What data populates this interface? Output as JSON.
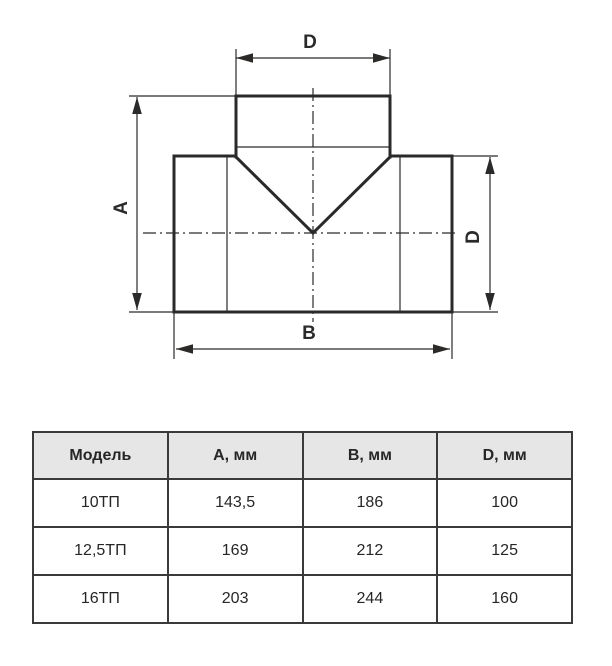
{
  "drawing": {
    "description": "tee-pipe-fitting-dimension-drawing",
    "line_color": "#2b2a29",
    "dimension_labels": {
      "top": "D",
      "left": "A",
      "bottom": "B",
      "right": "D"
    }
  },
  "table": {
    "header_bg": "#e6e6e6",
    "border_color": "#3a3a3a",
    "headers": [
      "Модель",
      "А, мм",
      "В, мм",
      "D, мм"
    ],
    "rows": [
      {
        "model": "10ТП",
        "a_mm": "143,5",
        "b_mm": "186",
        "d_mm": "100"
      },
      {
        "model": "12,5ТП",
        "a_mm": "169",
        "b_mm": "212",
        "d_mm": "125"
      },
      {
        "model": "16ТП",
        "a_mm": "203",
        "b_mm": "244",
        "d_mm": "160"
      }
    ]
  }
}
